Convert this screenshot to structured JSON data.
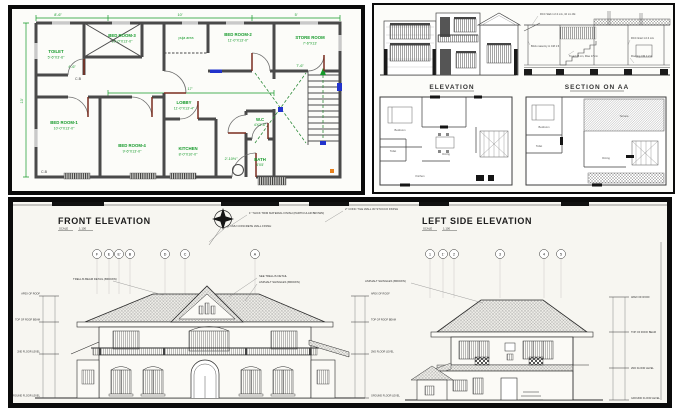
{
  "colors": {
    "wall_gray": "#4a4a4a",
    "dim_green": "#149929",
    "accent_blue": "#2233cc",
    "door_maroon": "#7a2c1f",
    "ink": "#2b2b2b",
    "panel_border": "#0b0b0b"
  },
  "floor_plan": {
    "rooms": {
      "toilet": {
        "name": "TOILET",
        "dims": "5'-6\"X3'-6\""
      },
      "bed3": {
        "name": "BED ROOM-3",
        "dims": "10'-0\"X13'-0\""
      },
      "puja": {
        "name": "puja area"
      },
      "bed2": {
        "name": "BED ROOM-2",
        "dims": "11'-0\"X13'-0\""
      },
      "store": {
        "name": "STORE ROOM",
        "dims": "7'-6\"X13'"
      },
      "lobby": {
        "name": "LOBBY",
        "dims": "11'-0\"X13'-4\""
      },
      "bed1": {
        "name": "BED ROOM-1",
        "dims": "10'-0\"X13'-0\""
      },
      "bed4": {
        "name": "BED ROOM-4",
        "dims": "9'-6\"X13'-0\""
      },
      "kitchen": {
        "name": "KITCHEN",
        "dims": "8'-0\"X10'-0\""
      },
      "wc": {
        "name": "W.C",
        "dims": "4'X3'-6\""
      },
      "bath": {
        "name": "BATH",
        "dims": "4'X5'"
      }
    },
    "tags": {
      "cb_top": "C.B",
      "cb_bottom": "C.B",
      "up": "UP"
    },
    "dims": {
      "d1": "8'-6\"",
      "d2": "10'",
      "d3": "5'",
      "d4": "17'",
      "d5": "4'-6\"",
      "d6": "7'-6\"",
      "d7": "2'-10½\"",
      "d8": "13'"
    }
  },
  "sheet2": {
    "elevation_title": "ELEVATION",
    "section_title": "SECTION ON AA",
    "notes": {
      "n1": "RCC Slab 1:2:4 mix, 10 cm thk",
      "n2": "Brick masonry in CM 1:6",
      "n3": "Tread 25 cm, Rise 17 cm",
      "n4": "RCC lintel 1:2:4 mix",
      "n5": "Flooring CM 1:2:4"
    },
    "plan_a": {
      "r1": "Bedroom",
      "r2": "Toilet",
      "r3": "Dining",
      "r4": "Kitchen"
    },
    "plan_b": {
      "r1": "Bedroom",
      "r2": "Toilet",
      "r3": "Terrace",
      "r4": "Dining"
    }
  },
  "sheet3": {
    "front": {
      "title": "FRONT ELEVATION",
      "scale_label": "SCALE",
      "scale_value": "1:100",
      "bubbles": {
        "b1": "F",
        "b2": "E",
        "b3": "E'",
        "b4": "B",
        "b5": "D",
        "b6": "C",
        "b7": "A"
      }
    },
    "side": {
      "title": "LEFT SIDE ELEVATION",
      "scale_label": "SCALE",
      "scale_value": "1:100",
      "bubbles": {
        "b1": "1",
        "b2": "1'",
        "b3": "2",
        "b4": "3",
        "b5": "4",
        "b6": "5"
      }
    },
    "levels": {
      "apex": "APEX OF ROOF",
      "beam": "TOP OF ROOF BEAM",
      "floor2": "2ND FLOOR LEVEL",
      "ground": "GROUND FLOOR LEVEL"
    },
    "notes": {
      "trim": "1\" THICK TRIM MATERIAL FINISH (PARTICULAR BROWN)",
      "cmu": "4\" CMU CONCRETE WALL FINISH",
      "stucco": "2\" CONC TILE WALL W/ STUCCO FINISH",
      "trellis": "SEE TRELLIS DETAIL",
      "shingles": "ASPHALT SHINGLES (BROWN)",
      "shingles2": "ASPHALT SHINGLES (BROWN)",
      "trellis_beam": "TRELLIS BEAM DETAIL (BROWN)"
    }
  }
}
